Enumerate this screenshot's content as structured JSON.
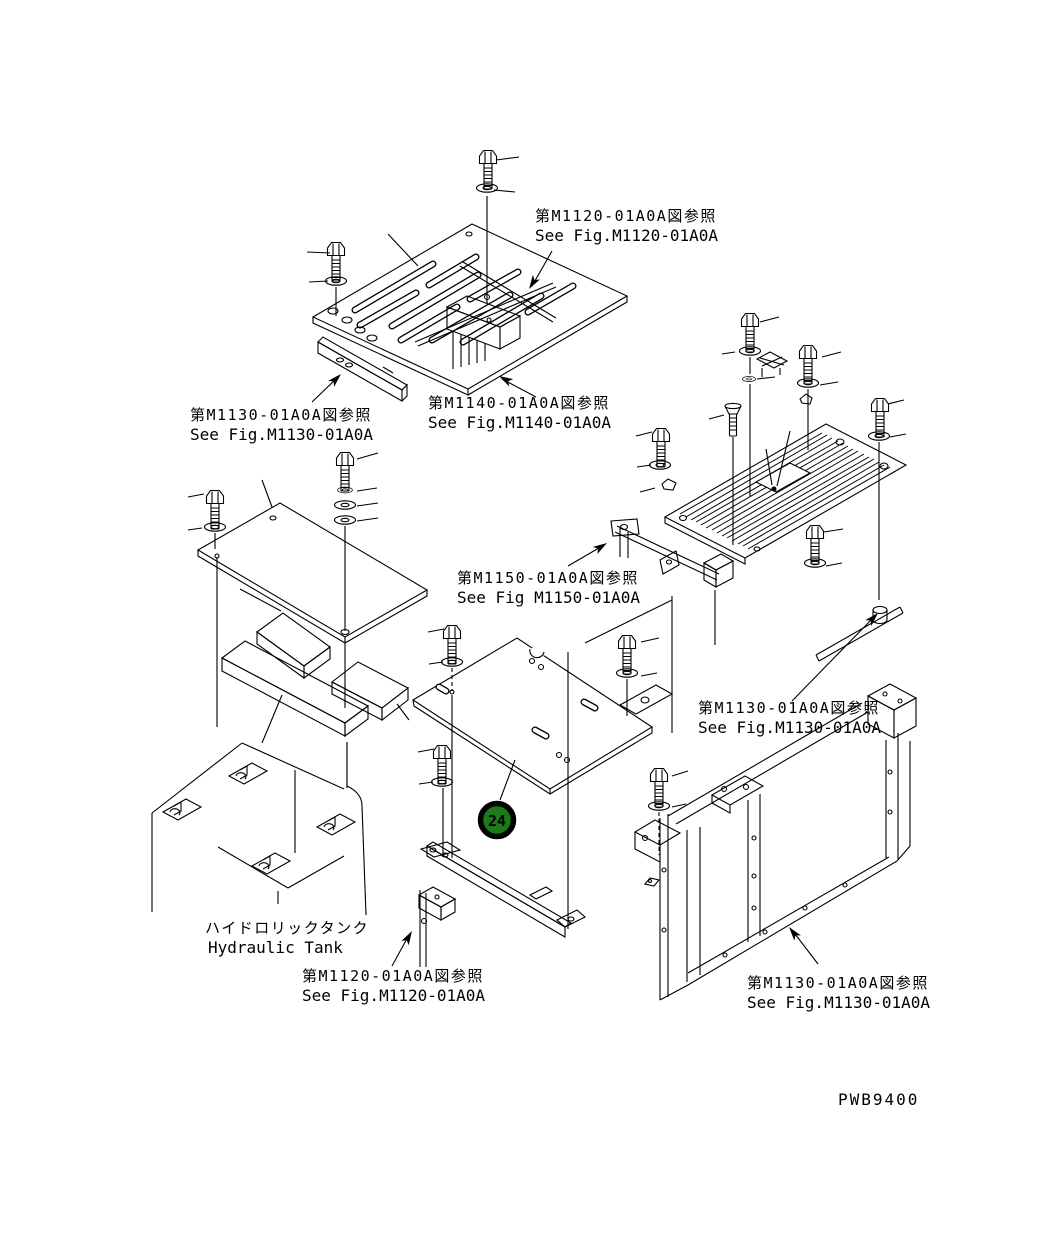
{
  "diagram": {
    "figure_code": "PWB9400",
    "balloon": {
      "number": "24"
    },
    "references": [
      {
        "id": "m1120-top",
        "jp": "第M1120-01A0A図参照",
        "en": "See Fig.M1120-01A0A"
      },
      {
        "id": "m1130-top-left",
        "jp": "第M1130-01A0A図参照",
        "en": "See Fig.M1130-01A0A"
      },
      {
        "id": "m1140",
        "jp": "第M1140-01A0A図参照",
        "en": "See Fig.M1140-01A0A"
      },
      {
        "id": "m1150",
        "jp": "第M1150-01A0A図参照",
        "en": "See Fig M1150-01A0A"
      },
      {
        "id": "m1130-right",
        "jp": "第M1130-01A0A図参照",
        "en": "See Fig.M1130-01A0A"
      },
      {
        "id": "m1120-bottom",
        "jp": "第M1120-01A0A図参照",
        "en": "See Fig.M1120-01A0A"
      },
      {
        "id": "m1130-bottom-right",
        "jp": "第M1130-01A0A図参照",
        "en": "See Fig.M1130-01A0A"
      }
    ],
    "tank_label": {
      "jp": "ハイドロリックタンク",
      "en": "Hydraulic Tank"
    },
    "colors": {
      "line": "#000000",
      "background": "#ffffff",
      "balloon_fill": "#1b7b1b",
      "balloon_ring": "#000000",
      "balloon_text": "#ffffff"
    }
  }
}
